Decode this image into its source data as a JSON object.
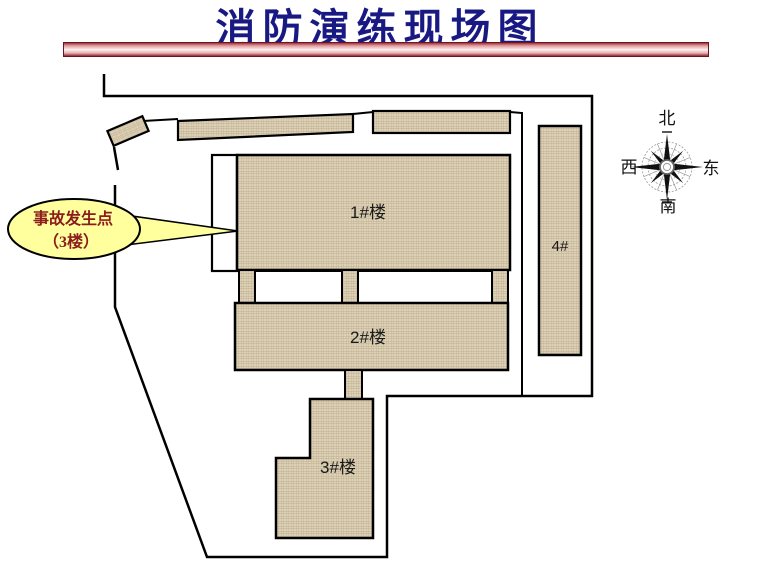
{
  "title": "消防演练现场图",
  "buildings": {
    "b1": "1#楼",
    "b2": "2#楼",
    "b3": "3#楼",
    "b4": "4#"
  },
  "callout": {
    "line1": "事故发生点",
    "line2": "（3楼）"
  },
  "compass": {
    "north": "北",
    "south": "南",
    "east": "东",
    "west": "西"
  },
  "colors": {
    "title_text": "#191984",
    "building_fill": "#ddd1b6",
    "building_hatch": "#b3a385",
    "outline": "#000000",
    "callout_fill": "#ffff9e",
    "callout_text": "#8b1c1c",
    "divider_dark": "#8c2a38",
    "divider_light": "#fdf0f0"
  }
}
